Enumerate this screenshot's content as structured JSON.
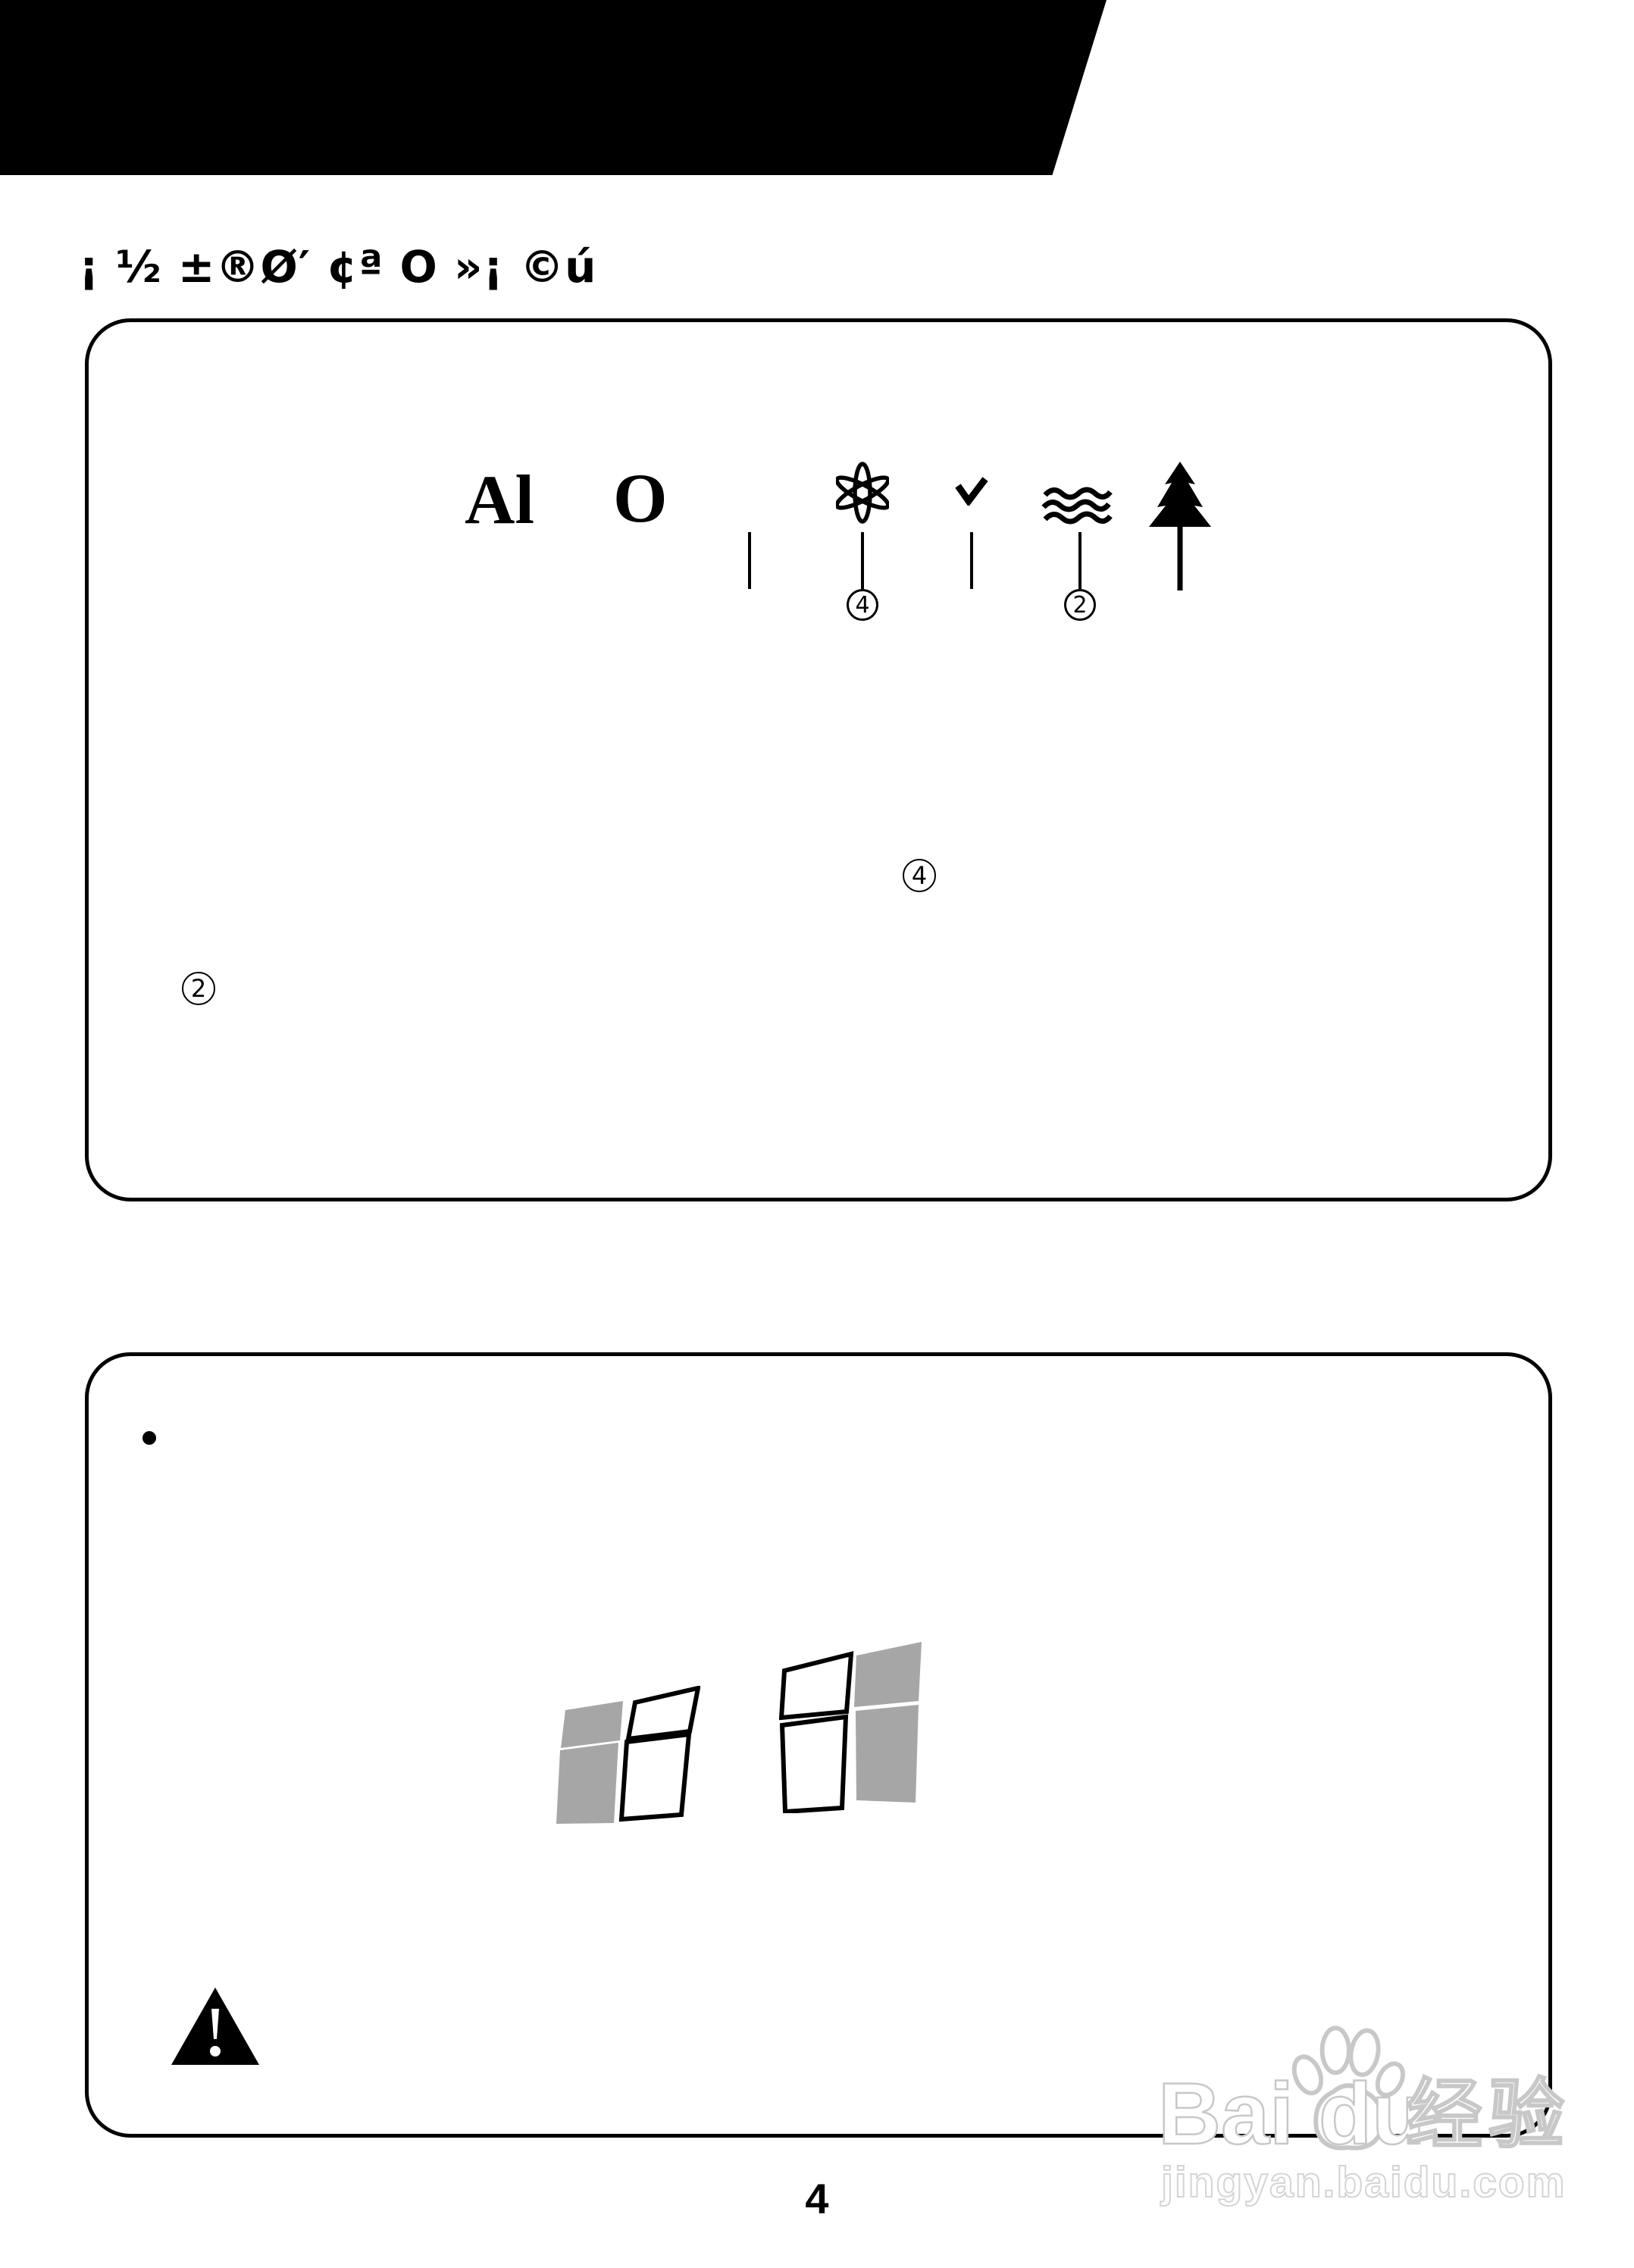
{
  "header": {
    "title": "¡ ½ ±®Ø′ ¢ª O »¡ ©ú"
  },
  "panel1": {
    "al_label": "Al",
    "o_label": "O",
    "icons": [
      "anion-atom-icon",
      "check-icon",
      "airflow-waves-icon",
      "pine-tree-icon"
    ],
    "callout_top_4": "4",
    "callout_top_2": "2",
    "callout_mid_4": "4",
    "callout_left_2": "2"
  },
  "panel2": {
    "bullet": "•",
    "icons": [
      "window-logo-left",
      "window-logo-right",
      "warning-triangle-icon"
    ]
  },
  "watermark": {
    "brand": "Bai",
    "brand2": "du",
    "cjk": "经验",
    "url": "jingyan.baidu.com",
    "icons": [
      "baidu-paw-icon"
    ]
  },
  "footer": {
    "page_number": "4"
  },
  "colors": {
    "banner_black": "#000000",
    "pane_gray": "#a6a6a6",
    "watermark_gray": "#c8c8c8"
  }
}
